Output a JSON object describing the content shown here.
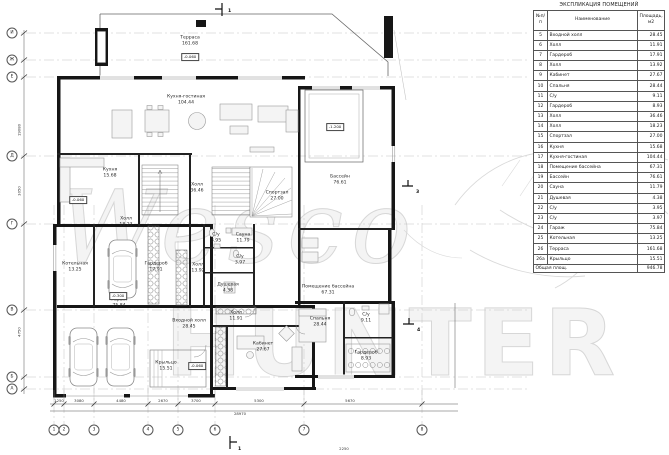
{
  "watermark": {
    "line1": "Wesco",
    "line2": "HUNTER"
  },
  "schedule": {
    "title": "ЭКСПЛИКАЦИЯ ПОМЕЩЕНИЙ",
    "columns": [
      "№п/п",
      "Наименование",
      "Площадь, м2"
    ],
    "rows": [
      [
        "5",
        "Входной холл",
        "28.45"
      ],
      [
        "6",
        "Холл",
        "11.91"
      ],
      [
        "7",
        "Гардероб",
        "17.91"
      ],
      [
        "8",
        "Холл",
        "13.92"
      ],
      [
        "9",
        "Кабинет",
        "27.67"
      ],
      [
        "10",
        "Спальня",
        "28.44"
      ],
      [
        "11",
        "С/у",
        "9.11"
      ],
      [
        "12",
        "Гардероб",
        "8.93"
      ],
      [
        "13",
        "Холл",
        "36.46"
      ],
      [
        "14",
        "Холл",
        "18.23"
      ],
      [
        "15",
        "Спортзал",
        "27.00"
      ],
      [
        "16",
        "Кухня",
        "15.68"
      ],
      [
        "17",
        "Кухня-гостиная",
        "104.44"
      ],
      [
        "18",
        "Помещение бассейна",
        "67.31"
      ],
      [
        "19",
        "Бассейн",
        "76.61"
      ],
      [
        "20",
        "Сауна",
        "11.79"
      ],
      [
        "21",
        "Душевая",
        "4.38"
      ],
      [
        "22",
        "С/у",
        "3.95"
      ],
      [
        "23",
        "С/у",
        "3.97"
      ],
      [
        "24",
        "Гараж",
        "75.84"
      ],
      [
        "25",
        "Котельная",
        "13.25"
      ],
      [
        "26",
        "Терраса",
        "161.68"
      ],
      [
        "26а",
        "Крыльцо",
        "15.51"
      ]
    ],
    "total_label": "Общая площ.",
    "total_value": "946.78"
  },
  "plan": {
    "rooms": [
      {
        "name": "Терраса",
        "area": "161.68",
        "x": 190,
        "y": 41
      },
      {
        "name": "Кухня-гостиная",
        "area": "104.44",
        "x": 186,
        "y": 100
      },
      {
        "name": "Кухня",
        "area": "15.68",
        "x": 110,
        "y": 173
      },
      {
        "name": "Холл",
        "area": "36.46",
        "x": 197,
        "y": 188
      },
      {
        "name": "Холл",
        "area": "18.23",
        "x": 126,
        "y": 222
      },
      {
        "name": "Спортзал",
        "area": "27.00",
        "x": 277,
        "y": 196
      },
      {
        "name": "Бассейн",
        "area": "76.61",
        "x": 340,
        "y": 180
      },
      {
        "name": "С/у",
        "area": "3.95",
        "x": 216,
        "y": 238
      },
      {
        "name": "Сауна",
        "area": "11.79",
        "x": 243,
        "y": 238
      },
      {
        "name": "С/у",
        "area": "3.97",
        "x": 240,
        "y": 260
      },
      {
        "name": "Душевая",
        "area": "4.38",
        "x": 228,
        "y": 288
      },
      {
        "name": "Помещение бассейна",
        "area": "67.31",
        "x": 328,
        "y": 290
      },
      {
        "name": "Котельная",
        "area": "13.25",
        "x": 75,
        "y": 267
      },
      {
        "name": "Гардероб",
        "area": "17.91",
        "x": 156,
        "y": 267
      },
      {
        "name": "Холл",
        "area": "13.92",
        "x": 198,
        "y": 268
      },
      {
        "name": "Гараж",
        "area": "75.84",
        "x": 119,
        "y": 303
      },
      {
        "name": "Холл",
        "area": "11.91",
        "x": 236,
        "y": 316
      },
      {
        "name": "Входной холл",
        "area": "28.45",
        "x": 189,
        "y": 324
      },
      {
        "name": "Крыльцо",
        "area": "15.51",
        "x": 166,
        "y": 366
      },
      {
        "name": "Кабинет",
        "area": "27.67",
        "x": 263,
        "y": 347
      },
      {
        "name": "Спальня",
        "area": "28.44",
        "x": 320,
        "y": 322
      },
      {
        "name": "С/у",
        "area": "9.11",
        "x": 366,
        "y": 318
      },
      {
        "name": "Гардероб",
        "area": "8.93",
        "x": 366,
        "y": 356
      }
    ],
    "levels": [
      {
        "text": "-0.060",
        "x": 190,
        "y": 57
      },
      {
        "text": "-0.060",
        "x": 78,
        "y": 200
      },
      {
        "text": "-0.300",
        "x": 118,
        "y": 296
      },
      {
        "text": "-1.200",
        "x": 335,
        "y": 127
      },
      {
        "text": "-0.060",
        "x": 197,
        "y": 366
      }
    ],
    "grid_rows": [
      {
        "label": "И",
        "y": 33
      },
      {
        "label": "Ж",
        "y": 60
      },
      {
        "label": "Е",
        "y": 77
      },
      {
        "label": "Д",
        "y": 156
      },
      {
        "label": "Г",
        "y": 224
      },
      {
        "label": "В",
        "y": 310
      },
      {
        "label": "Б",
        "y": 377
      },
      {
        "label": "А",
        "y": 389
      }
    ],
    "grid_cols": [
      {
        "label": "1",
        "x": 54
      },
      {
        "label": "2",
        "x": 64
      },
      {
        "label": "3",
        "x": 94
      },
      {
        "label": "4",
        "x": 148
      },
      {
        "label": "5",
        "x": 178
      },
      {
        "label": "6",
        "x": 215
      },
      {
        "label": "7",
        "x": 304
      },
      {
        "label": "8",
        "x": 422
      }
    ],
    "dims_bottom": [
      {
        "text": "1250",
        "x": 59
      },
      {
        "text": "3080",
        "x": 79
      },
      {
        "text": "4480",
        "x": 121
      },
      {
        "text": "2670",
        "x": 163
      },
      {
        "text": "3700",
        "x": 196
      },
      {
        "text": "5300",
        "x": 259
      },
      {
        "text": "5670",
        "x": 350
      }
    ],
    "dims_left": [
      {
        "text": "19080",
        "y": 130
      },
      {
        "text": "3050",
        "y": 191
      },
      {
        "text": "4750",
        "y": 332
      }
    ],
    "annotations": [
      {
        "text": "28970",
        "x": 240,
        "y": 416
      },
      {
        "text": "2250",
        "x": 344,
        "y": 451
      }
    ],
    "section_marks": [
      {
        "label": "1",
        "x": 228,
        "y": 9
      },
      {
        "label": "1",
        "x": 238,
        "y": 447
      },
      {
        "label": "3",
        "x": 416,
        "y": 190
      },
      {
        "label": "4",
        "x": 417,
        "y": 328
      }
    ]
  }
}
